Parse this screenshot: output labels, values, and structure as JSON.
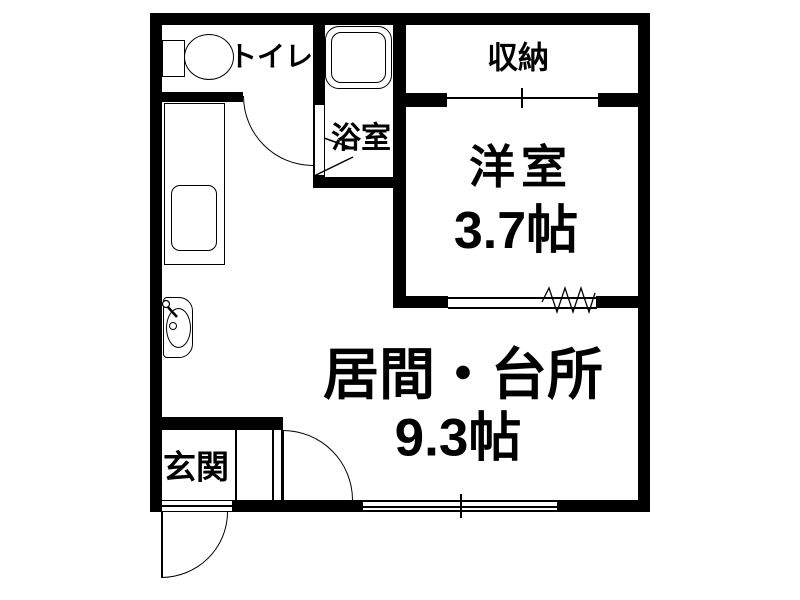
{
  "floorplan": {
    "rooms": {
      "toilet": {
        "label": "トイレ"
      },
      "bath": {
        "label": "浴室"
      },
      "storage": {
        "label": "収納"
      },
      "western": {
        "label": "洋室",
        "size": "3.7帖"
      },
      "living_kitchen": {
        "label": "居間・台所",
        "size": "9.3帖"
      },
      "entrance": {
        "label": "玄関"
      }
    },
    "icons": {
      "toilet_fixture": "toilet-icon",
      "bathtub": "bathtub-icon",
      "kitchen_sink": "kitchen-sink-icon",
      "wash_basin": "wash-basin-icon",
      "door_swing": "door-arc-icon",
      "sliding_window": "window-icon",
      "folding_door": "zigzag-door-icon"
    },
    "colors": {
      "wall": "#000000",
      "floor": "#ffffff",
      "text": "#000000"
    }
  }
}
